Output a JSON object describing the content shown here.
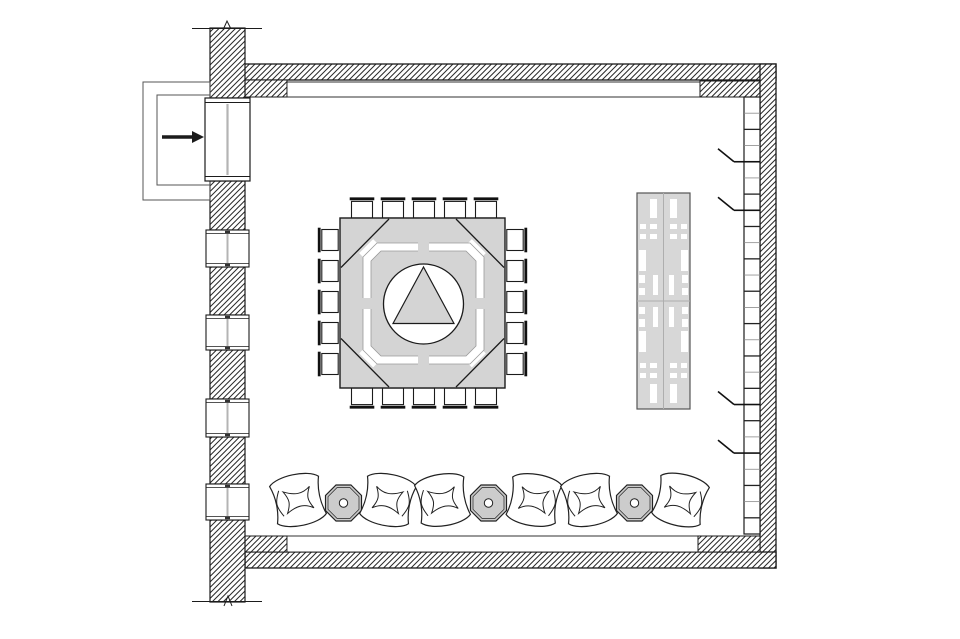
{
  "plan": {
    "type": "architectural-floor-plan",
    "canvas": {
      "width": 960,
      "height": 639,
      "background": "#ffffff"
    },
    "colors": {
      "line": "#1b1b1b",
      "thin_line": "#9a9a9a",
      "furniture_gray": "#d4d4d4",
      "octagon_table_gray": "#cccccc",
      "buffet_gray": "#d7d7d7",
      "glazing_gray": "#b4b4b4",
      "background": "#ffffff"
    },
    "entrance": {
      "arrow_icon": "right-arrow",
      "arrow": {
        "x1": 162,
        "y1": 137,
        "x2": 192,
        "head": 12
      },
      "outer_lobby_rect": {
        "x": 143,
        "y": 82,
        "w": 67,
        "h": 118
      },
      "inner_lobby_rect": {
        "x": 157,
        "y": 95,
        "w": 53,
        "h": 90
      },
      "door": {
        "x": 205,
        "y": 98,
        "w": 45,
        "h": 83
      }
    },
    "left_wall": {
      "x": 210,
      "w": 35,
      "top": 28,
      "bottom": 602,
      "hatch_segments": [
        [
          28,
          70
        ],
        [
          181,
          49
        ],
        [
          267,
          48
        ],
        [
          350,
          49
        ],
        [
          437,
          47
        ],
        [
          520,
          82
        ]
      ],
      "window_count": 4,
      "windows": [
        {
          "x": 206,
          "y": 230,
          "w": 43,
          "h": 37
        },
        {
          "x": 206,
          "y": 315,
          "w": 43,
          "h": 35
        },
        {
          "x": 206,
          "y": 399,
          "w": 43,
          "h": 38
        },
        {
          "x": 206,
          "y": 484,
          "w": 43,
          "h": 36
        }
      ],
      "break_marks": [
        {
          "y": 28.5
        },
        {
          "y": 601.5
        }
      ]
    },
    "right_wall": {
      "panel_strip": {
        "x": 744,
        "y": 97,
        "w": 16,
        "h": 437
      },
      "panel_count": 27,
      "tick_dividers": [
        4,
        7,
        19,
        22
      ]
    },
    "conference_area": {
      "table": {
        "x": 340,
        "y": 218,
        "w": 165,
        "h": 170
      },
      "circle": {
        "cx": 423.5,
        "cy": 304,
        "r": 40
      },
      "triangle": [
        [
          423.5,
          267
        ],
        [
          393,
          323.5
        ],
        [
          454,
          323.5
        ]
      ],
      "chair_count": 20,
      "chairs_per_side": 5,
      "chair_rows": [
        {
          "fixed": 208.2,
          "rot": 0,
          "axis": "x",
          "centers": [
            362,
            393,
            424,
            455,
            486
          ]
        },
        {
          "fixed": 397.8,
          "rot": 180,
          "axis": "x",
          "centers": [
            362,
            393,
            424,
            455,
            486
          ]
        },
        {
          "fixed": 328.6,
          "rot": -90,
          "axis": "y",
          "centers": [
            240,
            271,
            302,
            333,
            364
          ]
        },
        {
          "fixed": 516.4,
          "rot": 90,
          "axis": "y",
          "centers": [
            240,
            271,
            302,
            333,
            364
          ]
        }
      ]
    },
    "buffet": {
      "x": 637,
      "y": 193,
      "w": 53,
      "h": 216,
      "base_slots": [
        [
          13,
          6,
          7,
          19
        ],
        [
          3,
          31,
          6,
          5
        ],
        [
          13,
          31,
          7,
          5
        ],
        [
          3,
          41,
          6,
          5
        ],
        [
          13,
          41,
          7,
          5
        ],
        [
          2,
          57,
          7,
          21
        ],
        [
          16,
          82,
          5,
          20
        ],
        [
          2,
          82,
          6,
          8
        ],
        [
          2,
          95,
          6,
          7
        ]
      ]
    },
    "lounge": {
      "armchair_count": 6,
      "side_table_count": 3,
      "chair_cy": 500,
      "table_cy": 503,
      "items": [
        {
          "type": "armchair",
          "cx": 298,
          "rot": -12,
          "flip": false
        },
        {
          "type": "side-table",
          "cx": 343.5,
          "rot": 0,
          "flip": false
        },
        {
          "type": "armchair",
          "cx": 388,
          "rot": 12,
          "flip": true
        },
        {
          "type": "armchair",
          "cx": 442.5,
          "rot": -10,
          "flip": false
        },
        {
          "type": "side-table",
          "cx": 488.5,
          "rot": 0,
          "flip": false
        },
        {
          "type": "armchair",
          "cx": 534,
          "rot": 10,
          "flip": true
        },
        {
          "type": "armchair",
          "cx": 589,
          "rot": -12,
          "flip": false
        },
        {
          "type": "side-table",
          "cx": 634.5,
          "rot": 0,
          "flip": false
        },
        {
          "type": "armchair",
          "cx": 680.5,
          "rot": 14,
          "flip": true
        }
      ]
    }
  }
}
